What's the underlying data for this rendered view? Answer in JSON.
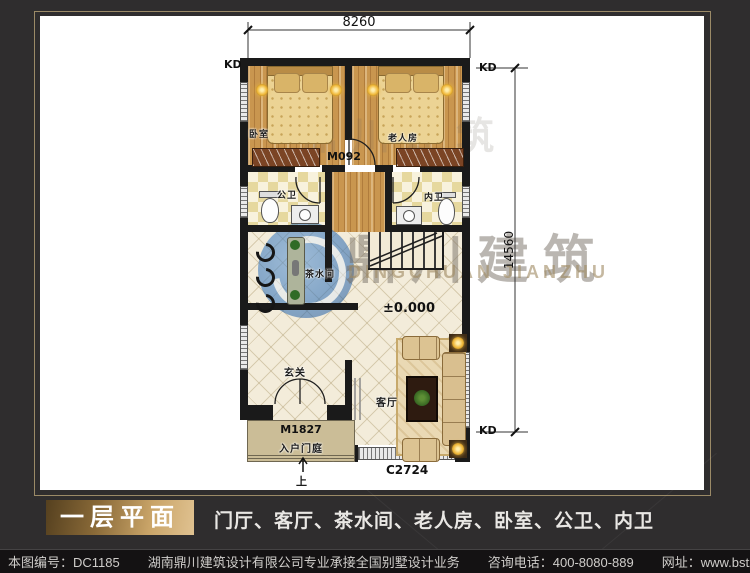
{
  "plan": {
    "dim_top": "8260",
    "dim_right": "14560",
    "level": "±0.000",
    "kd": "KD",
    "rooms": {
      "bedroom": "卧室",
      "elder_room": "老人房",
      "public_bath": "公卫",
      "inner_bath": "内卫",
      "tea_room": "茶水间",
      "foyer": "玄关",
      "living_room": "客厅",
      "entry_porch": "入户门庭",
      "up": "上"
    },
    "openings": {
      "door_inner": "M092",
      "door_entry": "M1827",
      "window_living": "C2724"
    }
  },
  "watermark": {
    "cn": "鼎川建筑",
    "en": "DINGCHUAN JIANZHU"
  },
  "title_bar": {
    "badge": "一层平面",
    "room_list": "门厅、客厅、茶水间、老人房、卧室、公卫、内卫"
  },
  "footer": {
    "drawing_no": "本图编号：DC1185",
    "company": "湖南鼎川建筑设计有限公司专业承接全国别墅设计业务",
    "phone": "咨询电话：400-8080-889",
    "website": "网址：www.bstzcs.com"
  },
  "colors": {
    "background": "#2f2d2e",
    "frame_gold": "#9b8a67",
    "badge_gold": "#c9a468",
    "watermark_blue": "#2a6db8",
    "wall": "#1a1a1a"
  }
}
